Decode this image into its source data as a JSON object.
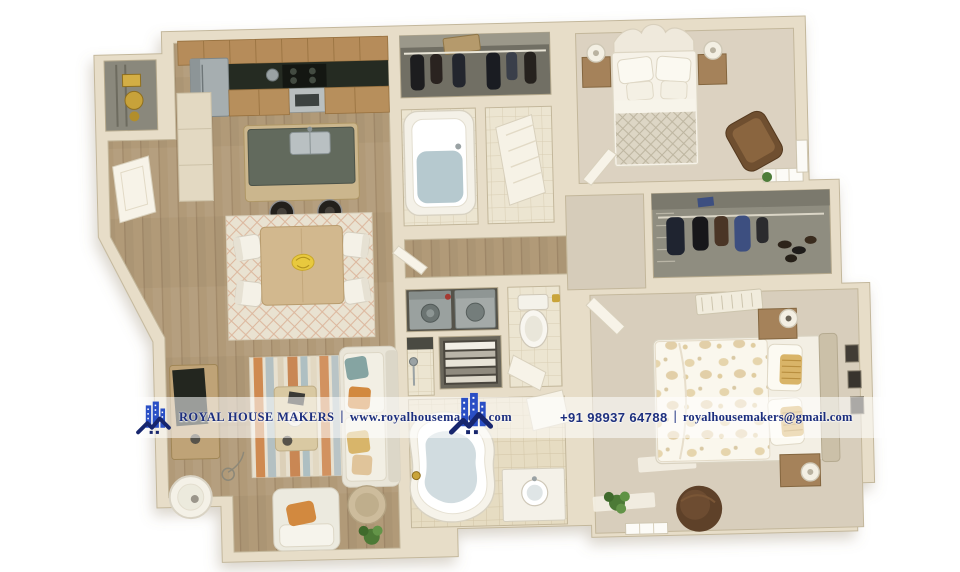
{
  "meta": {
    "description": "3D rendered top-down floor plan of a two-bedroom apartment with watermark banner",
    "canvas": {
      "width": 960,
      "height": 572
    },
    "background": "#ffffff"
  },
  "watermark": {
    "brand": "ROYAL HOUSE MAKERS",
    "separator": "|",
    "website": "www.royalhousemakers.com",
    "phone": "+91 98937 64788",
    "email": "royalhousemakers@gmail.com",
    "text_color": "#1d2f7e",
    "band_color": "rgba(255,255,255,0.55)",
    "logo": {
      "name": "royal-house-makers-logo",
      "building_color": "#2a4fc5",
      "roof_color": "#17266e"
    }
  },
  "scene": {
    "type": "3d-floor-plan-render",
    "rooms": [
      "kitchen",
      "dining-area",
      "living-room",
      "utility-closet",
      "entry",
      "reach-in-closet",
      "bathroom-1",
      "wc-room",
      "hallway",
      "laundry-closet",
      "linen-closet",
      "shower-room",
      "toilet-room",
      "bathroom-2",
      "bedroom-1",
      "walk-in-closet",
      "bedroom-2"
    ],
    "palette": {
      "wall": "#e7ddc8",
      "wall_edge": "#c3b79b",
      "wood_floor": "#b19a78",
      "carpet": "#dbd2c0",
      "tile": "#ece5d1",
      "closet_interior": "#716f64",
      "counter_dark": "#252b22",
      "cabinet_wood": "#b68c5a",
      "water_blue": "#b6c9cf",
      "accent_orange": "#d2893f",
      "accent_teal": "#85a4a2",
      "accent_gold": "#d9b468"
    }
  }
}
